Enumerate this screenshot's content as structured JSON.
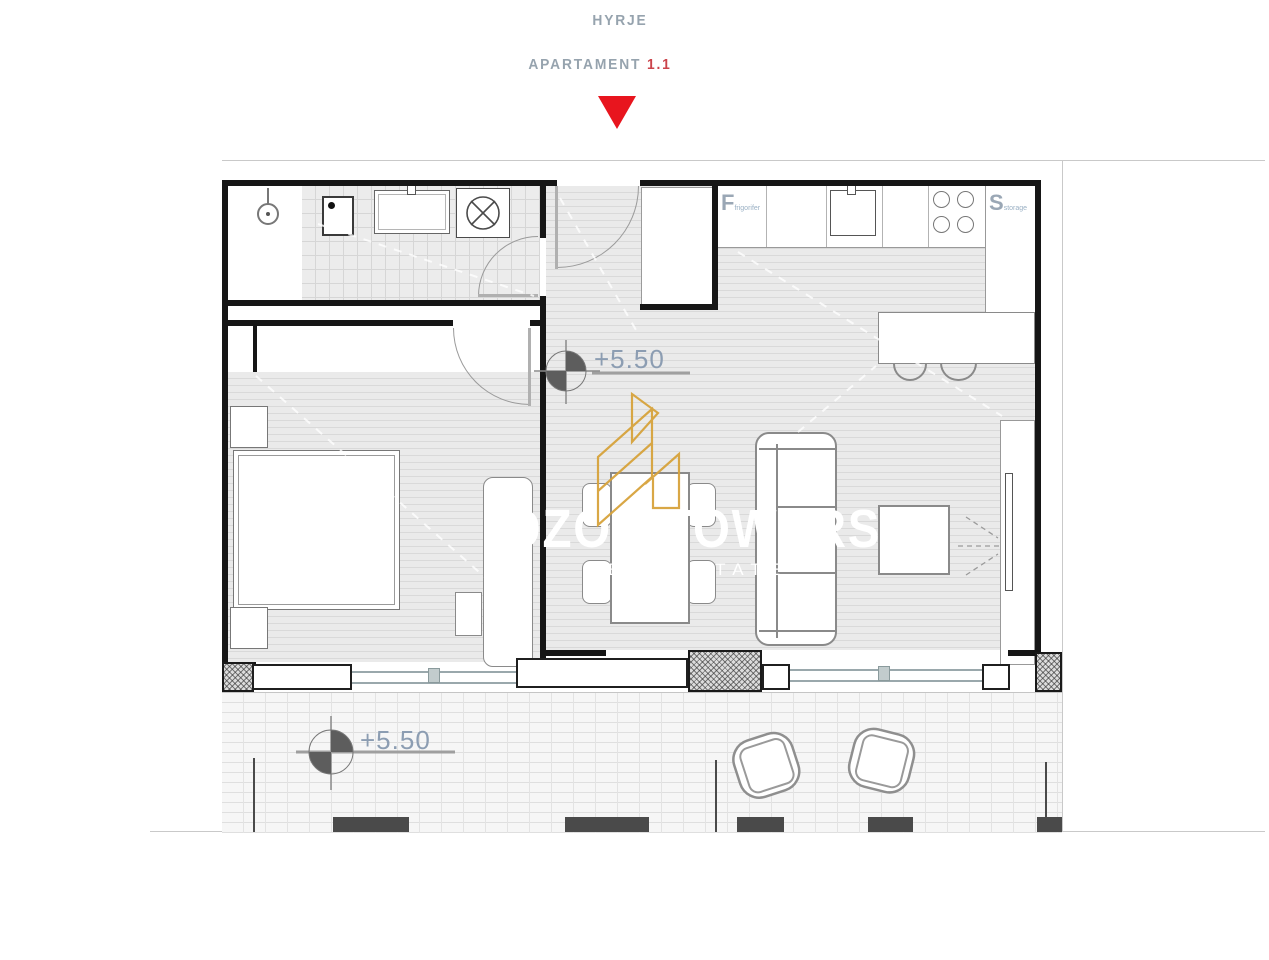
{
  "header": {
    "entrance_label": "HYRJE",
    "apartment_label": "APARTAMENT",
    "apartment_number": "1.1"
  },
  "markers": {
    "interior_elevation": "+5.50",
    "balcony_elevation": "+5.50"
  },
  "kitchen": {
    "fridge_abbr": "F",
    "fridge_name": "frigorifer",
    "storage_abbr": "S",
    "storage_name": "storage"
  },
  "watermark": {
    "brand": "OZON TOWERS",
    "tagline": "REAL ESTATE"
  },
  "colors": {
    "accent_red": "#E8151E",
    "label_gray": "#96A3AE",
    "elevation_blue": "#8C9DB2",
    "logo_gold": "#D7A33C",
    "wall_black": "#161616"
  }
}
